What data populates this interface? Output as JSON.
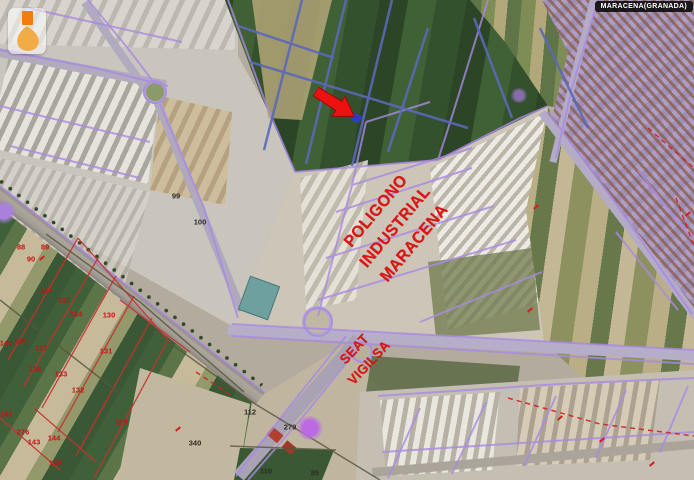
{
  "map": {
    "title_badge": "MARACENA(GRANADA)",
    "annotations": {
      "poligono": {
        "lines": [
          "POLIGONO",
          "INDUSTRIAL",
          "MARACENA"
        ],
        "color": "#e01313"
      },
      "seat": {
        "lines": [
          "SEAT",
          "VIGILSA"
        ],
        "color": "#e01313"
      },
      "arrow": {
        "color": "#ee1111"
      }
    },
    "parcel_numbers_red": [
      {
        "n": "88",
        "x": 21,
        "y": 247
      },
      {
        "n": "89",
        "x": 45,
        "y": 247
      },
      {
        "n": "90",
        "x": 31,
        "y": 259
      },
      {
        "n": "136",
        "x": 46,
        "y": 291
      },
      {
        "n": "135",
        "x": 64,
        "y": 300
      },
      {
        "n": "134",
        "x": 76,
        "y": 314
      },
      {
        "n": "130",
        "x": 109,
        "y": 315
      },
      {
        "n": "140",
        "x": 6,
        "y": 343
      },
      {
        "n": "139",
        "x": 20,
        "y": 341
      },
      {
        "n": "137",
        "x": 41,
        "y": 348
      },
      {
        "n": "131",
        "x": 106,
        "y": 351
      },
      {
        "n": "138",
        "x": 35,
        "y": 369
      },
      {
        "n": "133",
        "x": 61,
        "y": 374
      },
      {
        "n": "132",
        "x": 78,
        "y": 390
      },
      {
        "n": "142",
        "x": 6,
        "y": 414
      },
      {
        "n": "276",
        "x": 23,
        "y": 432
      },
      {
        "n": "143",
        "x": 34,
        "y": 442
      },
      {
        "n": "144",
        "x": 54,
        "y": 438
      },
      {
        "n": "128",
        "x": 121,
        "y": 422
      },
      {
        "n": "149",
        "x": 55,
        "y": 463
      }
    ],
    "parcel_numbers_dark": [
      {
        "n": "99",
        "x": 176,
        "y": 196
      },
      {
        "n": "100",
        "x": 200,
        "y": 222
      },
      {
        "n": "340",
        "x": 195,
        "y": 443
      },
      {
        "n": "112",
        "x": 250,
        "y": 412
      },
      {
        "n": "279",
        "x": 290,
        "y": 427
      },
      {
        "n": "110",
        "x": 266,
        "y": 471
      },
      {
        "n": "85",
        "x": 315,
        "y": 473
      }
    ],
    "red_marks": [
      {
        "x": 42,
        "y": 258
      },
      {
        "x": 178,
        "y": 429
      },
      {
        "x": 536,
        "y": 207
      },
      {
        "x": 530,
        "y": 310
      },
      {
        "x": 560,
        "y": 418
      },
      {
        "x": 602,
        "y": 440
      },
      {
        "x": 652,
        "y": 464
      },
      {
        "x": 688,
        "y": 214
      }
    ],
    "colors": {
      "cadastral_line": "#a98ae2",
      "field_line_blue": "#5c68b8",
      "parcel_line_red": "#c83030",
      "dashed_red": "#d42020",
      "field_boundary_dark": "#56573c",
      "annotation_red": "#e01313",
      "logo_orange": "#f07d10",
      "logo_amber": "#f2a93c"
    }
  }
}
